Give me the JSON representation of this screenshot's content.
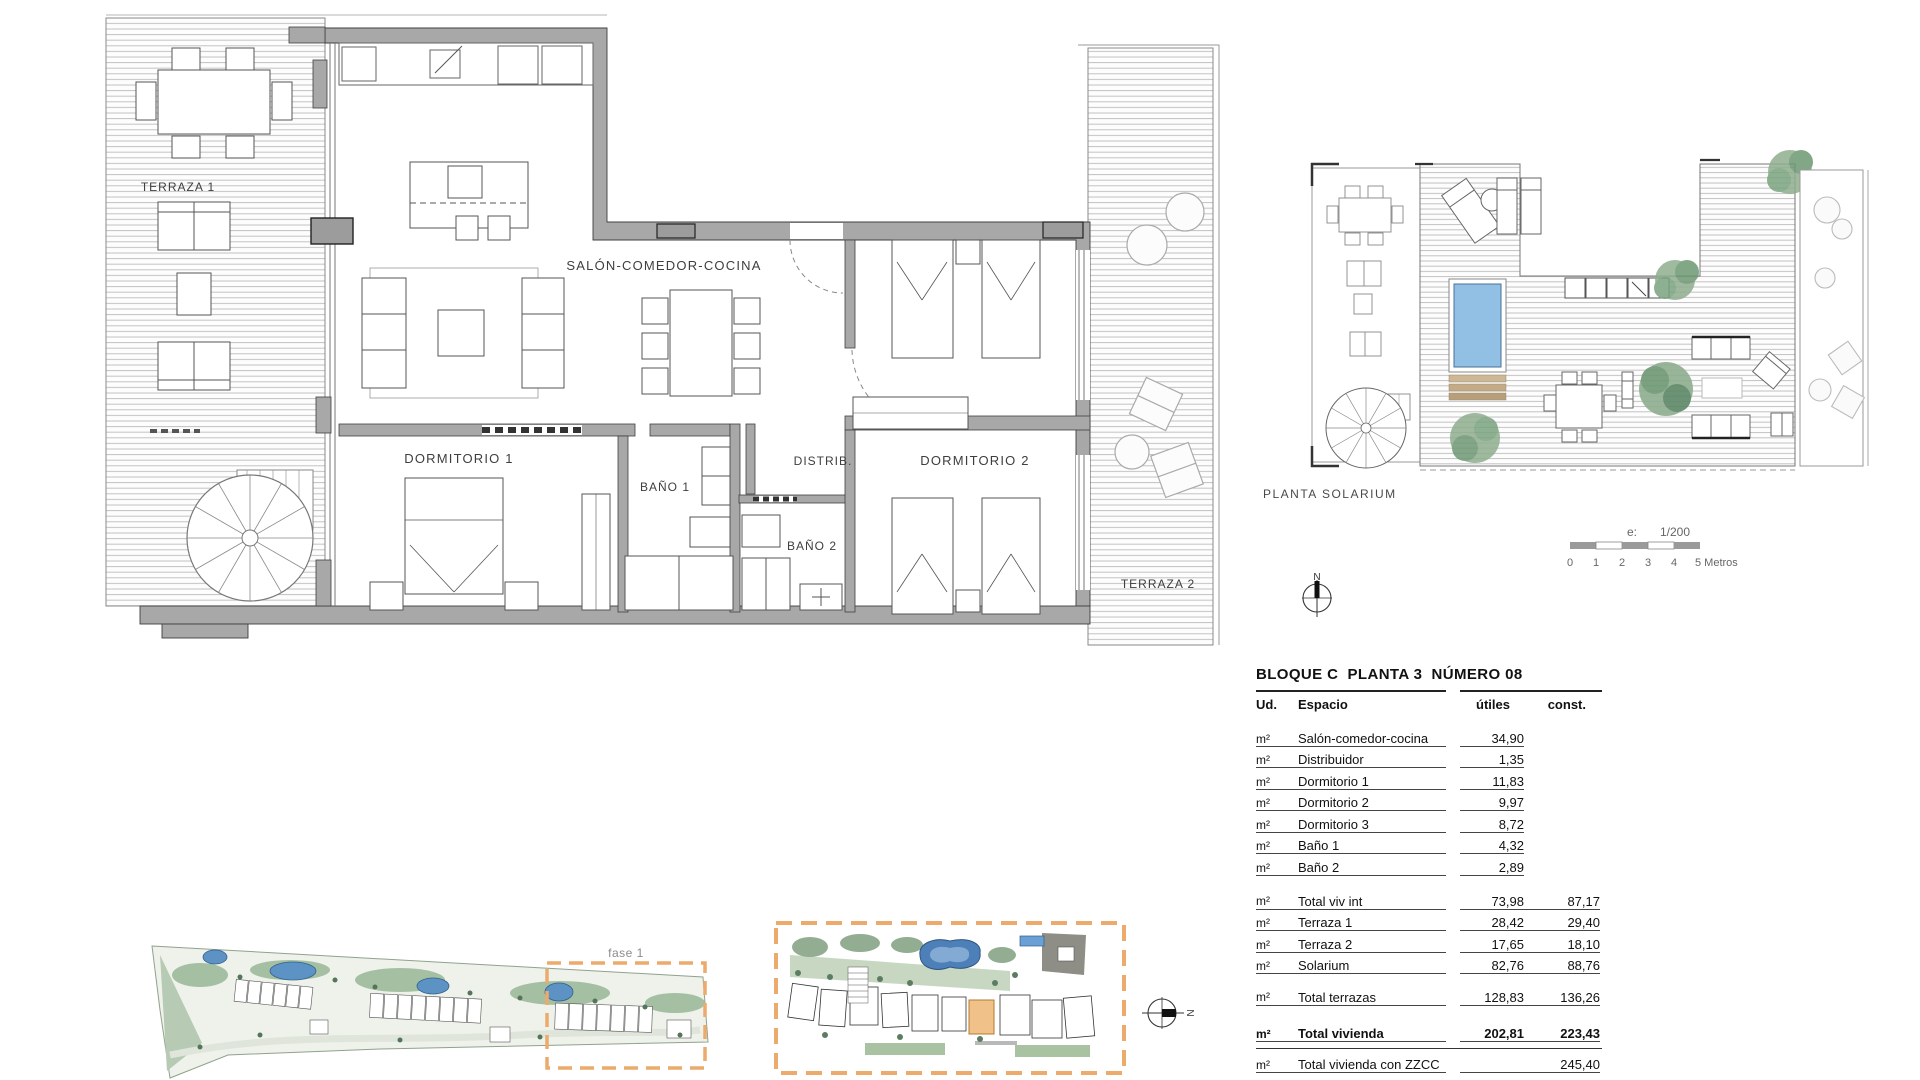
{
  "plan": {
    "labels": {
      "terraza1": "TERRAZA 1",
      "salon": "SALÓN-COMEDOR-COCINA",
      "dormitorio1": "DORMITORIO 1",
      "bano1": "BAÑO 1",
      "distrib": "DISTRIB.",
      "bano2": "BAÑO 2",
      "dormitorio2": "DORMITORIO 2",
      "terraza2": "TERRAZA 2"
    }
  },
  "solarium": {
    "title": "PLANTA SOLARIUM",
    "scale_prefix": "e:",
    "scale_ratio": "1/200",
    "ticks": [
      "0",
      "1",
      "2",
      "3",
      "4"
    ],
    "ticks_last": "5 Metros",
    "north": "N"
  },
  "site": {
    "phase_label": "fase 1",
    "north": "N"
  },
  "table": {
    "title": "BLOQUE C  PLANTA 3  NÚMERO 08",
    "col_ud": "Ud.",
    "col_espacio": "Espacio",
    "col_utiles": "útiles",
    "col_const": "const.",
    "rows": [
      {
        "ud": "m²",
        "espacio": "Salón-comedor-cocina",
        "utiles": "34,90",
        "const": ""
      },
      {
        "ud": "m²",
        "espacio": "Distribuidor",
        "utiles": "1,35",
        "const": ""
      },
      {
        "ud": "m²",
        "espacio": "Dormitorio 1",
        "utiles": "11,83",
        "const": ""
      },
      {
        "ud": "m²",
        "espacio": "Dormitorio 2",
        "utiles": "9,97",
        "const": ""
      },
      {
        "ud": "m²",
        "espacio": "Dormitorio 3",
        "utiles": "8,72",
        "const": ""
      },
      {
        "ud": "m²",
        "espacio": "Baño 1",
        "utiles": "4,32",
        "const": ""
      },
      {
        "ud": "m²",
        "espacio": "Baño 2",
        "utiles": "2,89",
        "const": ""
      },
      {
        "ud": "m²",
        "espacio": "Total viv int",
        "utiles": "73,98",
        "const": "87,17"
      },
      {
        "ud": "m²",
        "espacio": "Terraza 1",
        "utiles": "28,42",
        "const": "29,40"
      },
      {
        "ud": "m²",
        "espacio": "Terraza 2",
        "utiles": "17,65",
        "const": "18,10"
      },
      {
        "ud": "m²",
        "espacio": "Solarium",
        "utiles": "82,76",
        "const": "88,76"
      },
      {
        "ud": "m²",
        "espacio": "Total terrazas",
        "utiles": "128,83",
        "const": "136,26"
      },
      {
        "ud": "m²",
        "espacio": "Total vivienda",
        "utiles": "202,81",
        "const": "223,43"
      },
      {
        "ud": "m²",
        "espacio": "Total vivienda con ZZCC",
        "utiles": "",
        "const": "245,40"
      }
    ]
  },
  "colors": {
    "wall_gray": "#a8a8a8",
    "pool_blue": "#92bfe4",
    "site_pool_blue": "#4d80b8",
    "phase_orange": "#ecaa6c",
    "vegetation_green": "#93ad92"
  }
}
